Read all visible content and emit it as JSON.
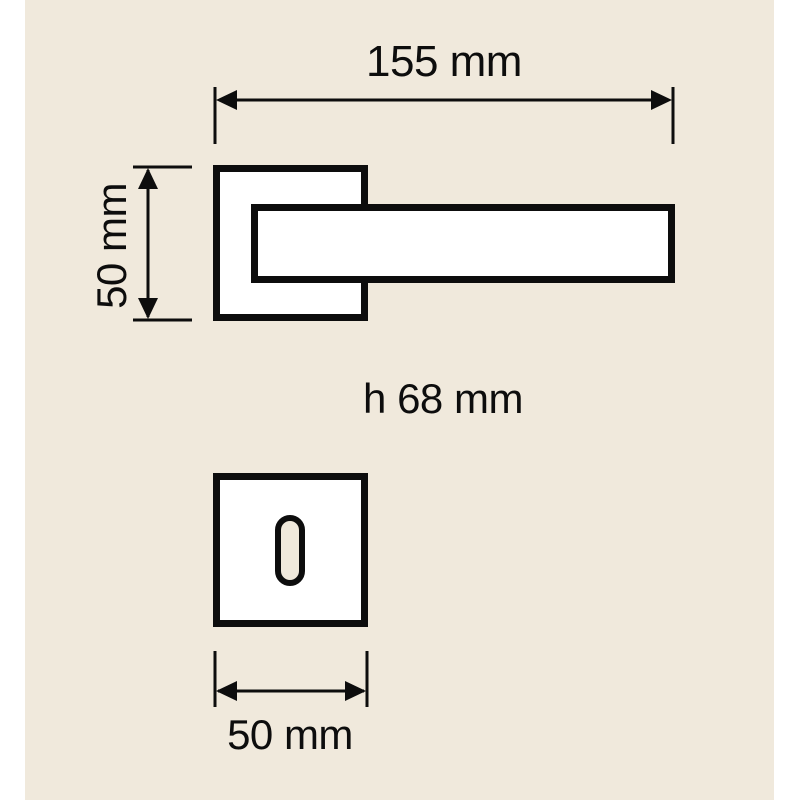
{
  "colors": {
    "page_margin": "#ffffff",
    "background": "#f0e9dc",
    "line": "#0d0d0d",
    "fill": "#ffffff"
  },
  "labels": {
    "total_width": "155 mm",
    "rose_height": "50 mm",
    "handle_height": "h 68 mm",
    "escutcheon_width": "50 mm"
  }
}
